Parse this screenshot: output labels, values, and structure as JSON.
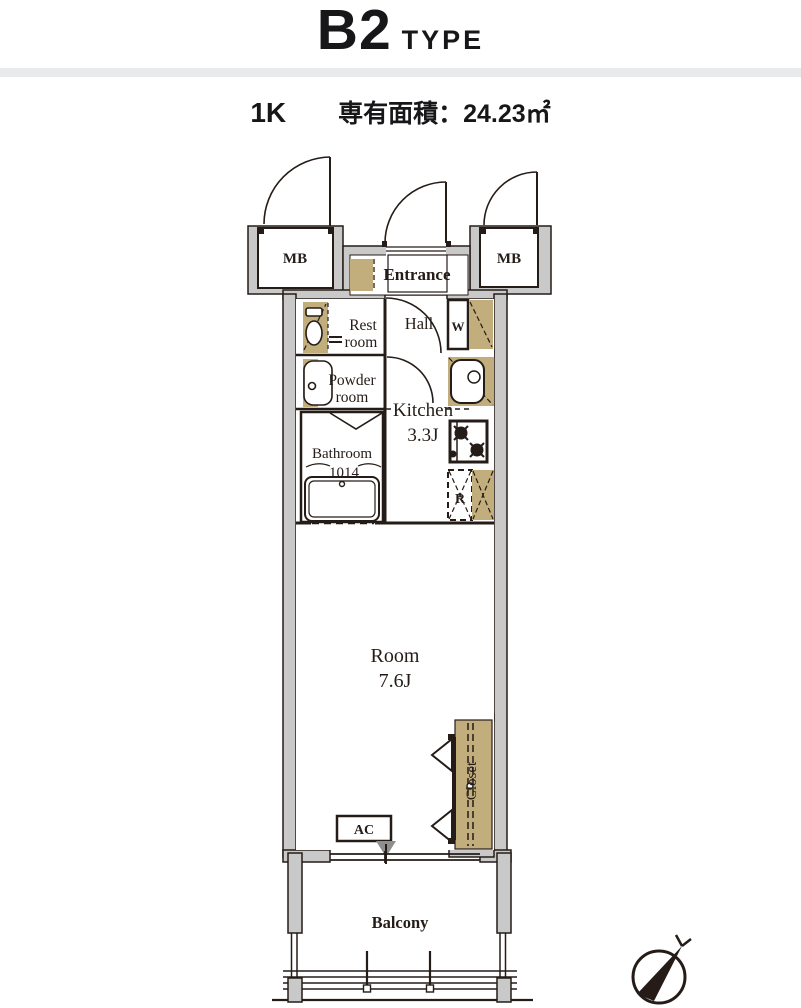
{
  "header": {
    "title": "B2",
    "title_suffix": "TYPE",
    "layout_type": "1K",
    "area": "専有面積：24.23㎡"
  },
  "plan": {
    "meter_box_left": "MB",
    "meter_box_right": "MB",
    "entrance": "Entrance",
    "restroom_line1": "Rest",
    "restroom_line2": "room",
    "hall": "Hall",
    "washer": "W",
    "powder_line1": "Powder",
    "powder_line2": "room",
    "kitchen_name": "Kitchen",
    "kitchen_size": "3.3J",
    "bathroom_name": "Bathroom",
    "bathroom_size": "1014",
    "fridge": "R",
    "room_name": "Room",
    "room_size": "7.6J",
    "closet": "Closet",
    "ac": "AC",
    "balcony": "Balcony"
  },
  "colors": {
    "ink": "#251c18",
    "wall_gray": "#c9c9ca",
    "fixture_tan": "#c2ae7c",
    "divider_gray": "#e8eaeb",
    "ac_arrow_gray": "#8f8f8f"
  }
}
